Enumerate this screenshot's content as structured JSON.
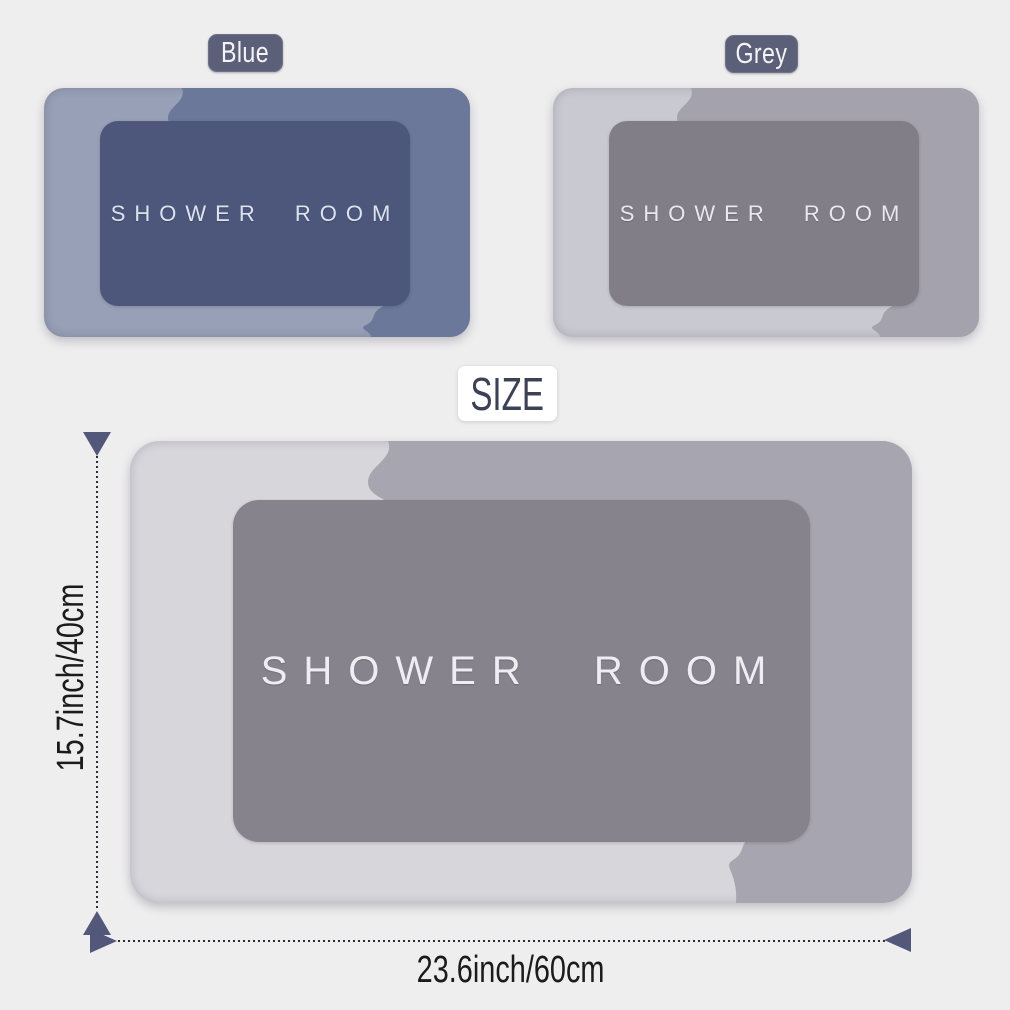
{
  "page": {
    "description": "Bath mat product size infographic"
  },
  "colors": {
    "page_bg": "#efeeef",
    "tag_bg": "#5b5f78",
    "tag_text": "#f4f4f7",
    "size_badge_bg": "#ffffff",
    "size_badge_text": "#3d4156",
    "blue_light": "#97a0b6",
    "blue_medium": "#6b7899",
    "blue_inner": "#4c577b",
    "blue_text": "#dde3ee",
    "grey_light": "#c9c9d1",
    "grey_medium": "#a3a2ad",
    "grey_inner": "#817e88",
    "grey_text": "#eae8ee",
    "big_light": "#d7d6db",
    "big_medium": "#a7a5b0",
    "big_inner": "#86838d",
    "big_text": "#efedf2",
    "dim_arrow": "#53577a",
    "dim_line": "#2c2c34",
    "dim_text": "#1b1b1b"
  },
  "variant_tags": {
    "blue": "Blue",
    "grey": "Grey"
  },
  "size_badge": "SIZE",
  "mats": {
    "blue": {
      "text": "SHOWER ROOM"
    },
    "grey": {
      "text": "SHOWER ROOM"
    },
    "large": {
      "text": "SHOWER ROOM"
    }
  },
  "dimensions": {
    "height": "15.7inch/40cm",
    "width": "23.6inch/60cm"
  }
}
